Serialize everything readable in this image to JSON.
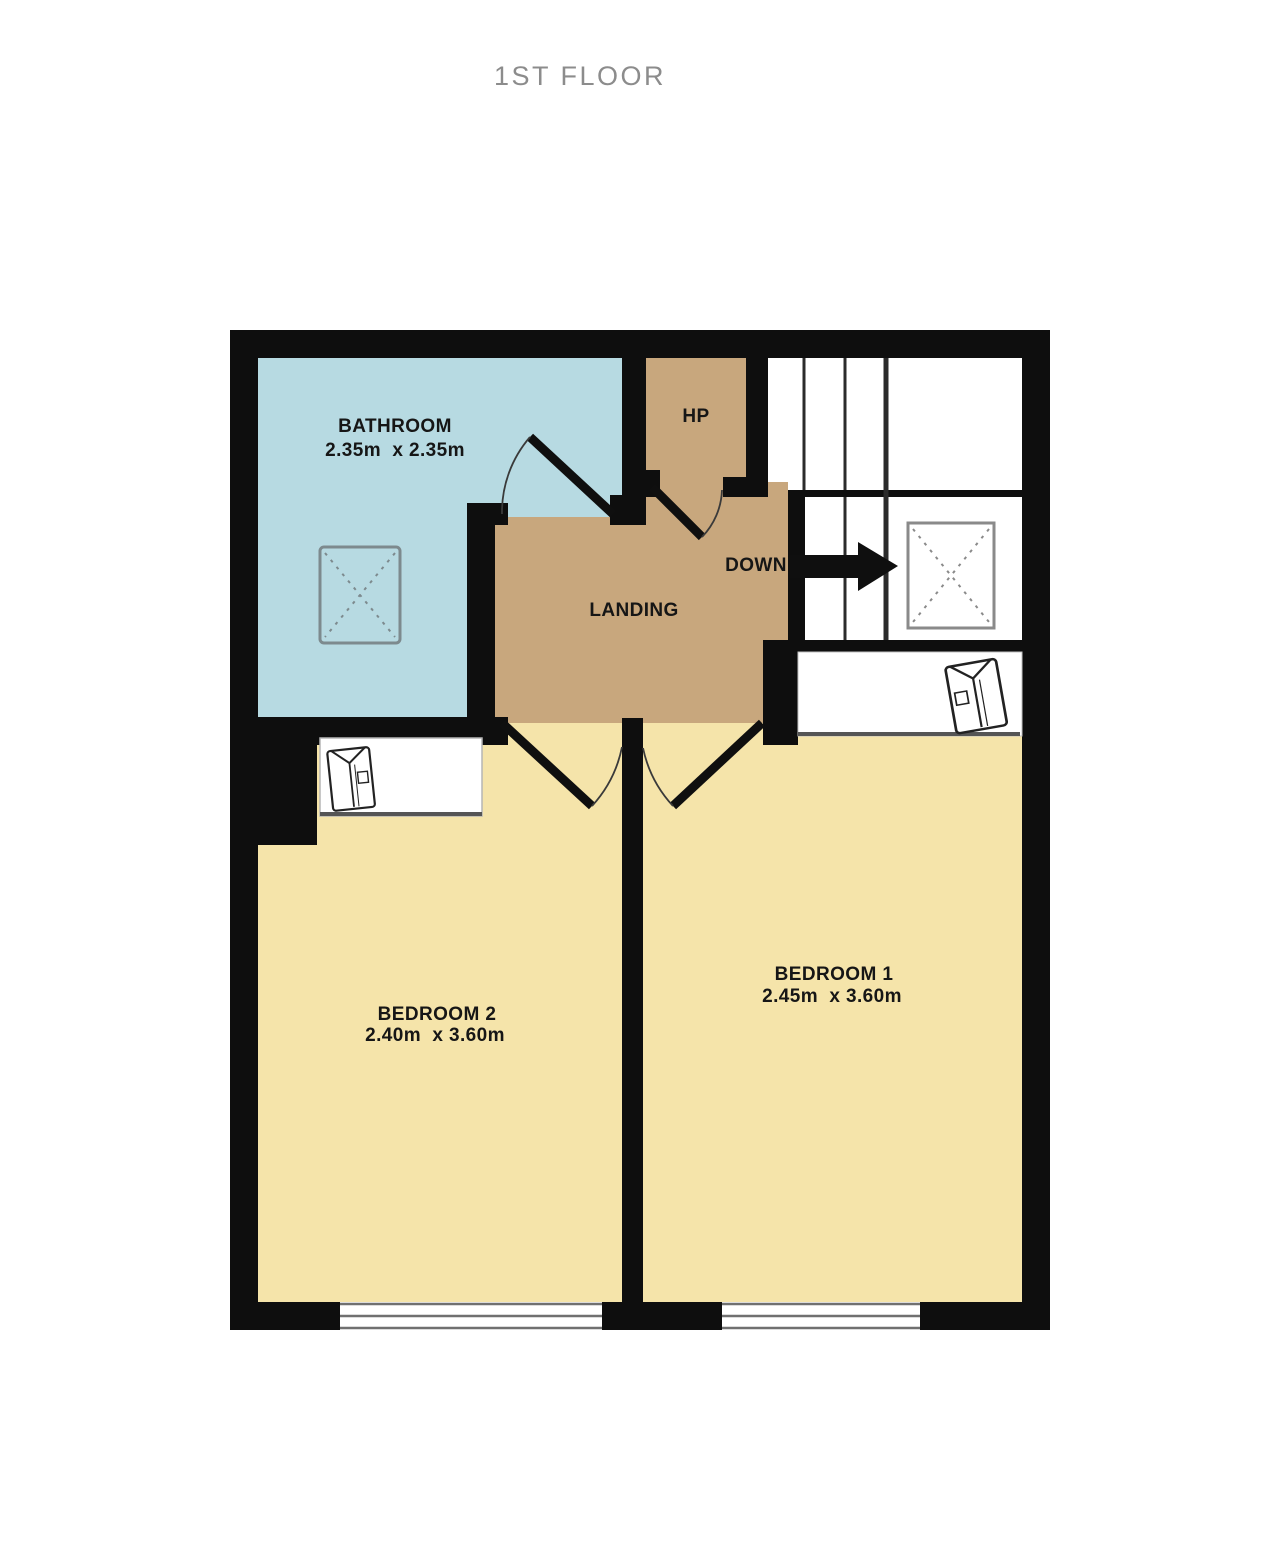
{
  "title": "1ST FLOOR",
  "colors": {
    "wall": "#0e0e0e",
    "bathroom_fill": "#b7dae2",
    "landing_fill": "#c8a77d",
    "bedroom_fill": "#f5e4aa",
    "floor_white": "#ffffff",
    "stair_line": "#2b2b2b",
    "window_line": "#707070",
    "fixture_line": "#7d8a8e",
    "label_text": "#161616",
    "title_text": "#8c8c8c"
  },
  "rooms": {
    "bathroom": {
      "label": "BATHROOM",
      "dims": "2.35m  x 2.35m"
    },
    "hp": {
      "label": "HP"
    },
    "landing": {
      "label": "LANDING"
    },
    "bedroom1": {
      "label": "BEDROOM 1",
      "dims": "2.45m  x 3.60m"
    },
    "bedroom2": {
      "label": "BEDROOM 2",
      "dims": "2.40m  x 3.60m"
    }
  },
  "stairs": {
    "direction_label": "DOWN"
  },
  "icons": {
    "down_arrow": "right-arrow-icon",
    "shower": "dashed-cross-box",
    "stairwell_void": "dashed-cross-box",
    "wardrobe_bedroom1": "folded-shirt-icon",
    "wardrobe_bedroom2": "folded-shirt-icon"
  }
}
